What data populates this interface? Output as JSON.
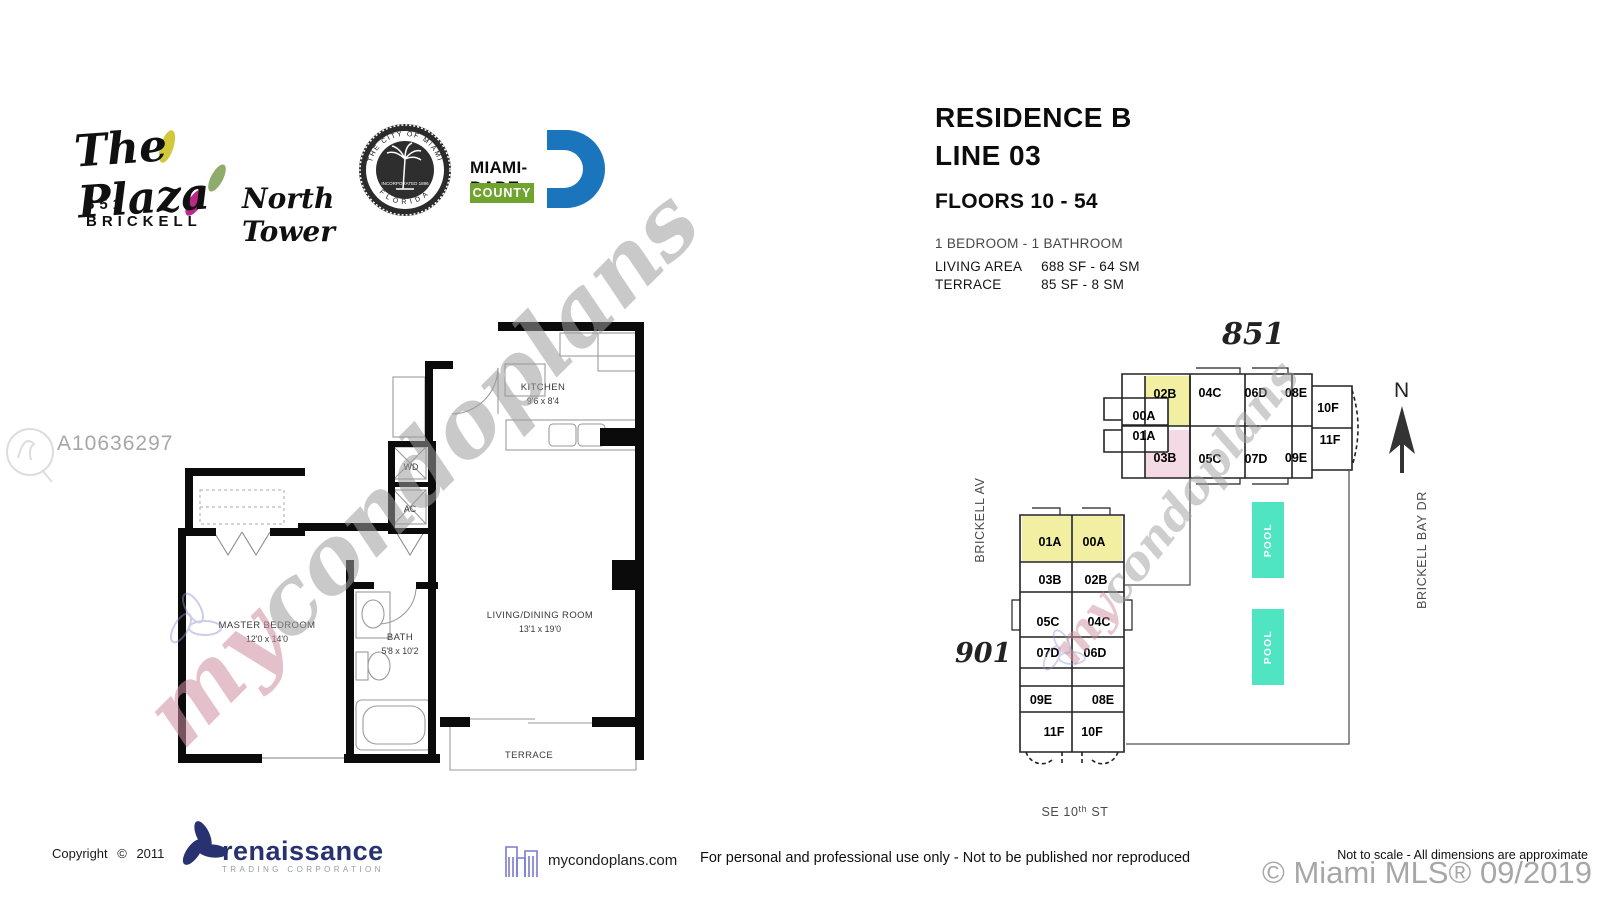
{
  "watermarks": {
    "listing_id": "A10636297",
    "brand_my": "my",
    "brand_rest": "condoplans",
    "mls_credit": "© Miami MLS® 09/2019"
  },
  "header": {
    "plaza": {
      "script": "The Plaza",
      "address": "851 BRICKELL"
    },
    "north_tower": "North Tower",
    "seal": {
      "arc_top": "THE CITY OF MIAMI",
      "arc_bottom": "FLORIDA",
      "banner": "INCORPORATED 1896"
    },
    "miami_dade": {
      "name": "MIAMI-DADE",
      "county": "COUNTY"
    }
  },
  "residence_info": {
    "residence": "RESIDENCE B",
    "line": "LINE 03",
    "floors": "FLOORS 10 - 54",
    "bed_bath": "1 BEDROOM - 1 BATHROOM",
    "living_area_label": "LIVING AREA",
    "living_area_value": "688 SF - 64 SM",
    "terrace_label": "TERRACE",
    "terrace_value": "85 SF -  8 SM"
  },
  "floor_plan": {
    "kitchen_name": "KITCHEN",
    "kitchen_dim": "9'6 x 8'4",
    "wd": "WD",
    "ac": "AC",
    "master_name": "MASTER BEDROOM",
    "master_dim": "12'0 x 14'0",
    "bath_name": "BATH",
    "bath_dim": "5'8 x 10'2",
    "living_name": "LIVING/DINING ROOM",
    "living_dim": "13'1 x 19'0",
    "terrace": "TERRACE"
  },
  "key_plan": {
    "label_851": "851",
    "label_901": "901",
    "north": "N",
    "street_west": "BRICKELL AV",
    "street_east": "BRICKELL BAY DR",
    "street_south_1": "SE 10",
    "street_south_sup": "th",
    "street_south_2": " ST",
    "pool": "POOL",
    "b851_units": [
      {
        "label": "02B"
      },
      {
        "label": "04C"
      },
      {
        "label": "06D"
      },
      {
        "label": "08E"
      },
      {
        "label": "10F"
      },
      {
        "label": "00A"
      },
      {
        "label": "01A"
      },
      {
        "label": "03B"
      },
      {
        "label": "05C"
      },
      {
        "label": "07D"
      },
      {
        "label": "09E"
      },
      {
        "label": "11F"
      }
    ],
    "b901_units": [
      {
        "label": "01A"
      },
      {
        "label": "00A"
      },
      {
        "label": "03B"
      },
      {
        "label": "02B"
      },
      {
        "label": "05C"
      },
      {
        "label": "04C"
      },
      {
        "label": "07D"
      },
      {
        "label": "06D"
      },
      {
        "label": "09E"
      },
      {
        "label": "08E"
      },
      {
        "label": "11F"
      },
      {
        "label": "10F"
      }
    ]
  },
  "footer": {
    "copyright": "Copyright ©  2011",
    "renaissance_name": "renaissance",
    "renaissance_sub": "TRADING CORPORATION",
    "site": "mycondoplans.com",
    "usage": "For personal and professional use only - Not to be published nor reproduced",
    "scale_note": "Not to scale - All dimensions are approximate"
  },
  "colors": {
    "walls": "#0b0b0b",
    "highlight_yellow": "#F2EFA3",
    "highlight_pink": "#F4DAE4",
    "pool": "#4FE5C3",
    "miami_dade_blue": "#1B75BC",
    "miami_dade_green": "#71A32F",
    "renaissance_navy": "#283271",
    "plaza_yellow": "#CDC32B",
    "plaza_green": "#86A55F",
    "plaza_magenta": "#B3177C"
  }
}
